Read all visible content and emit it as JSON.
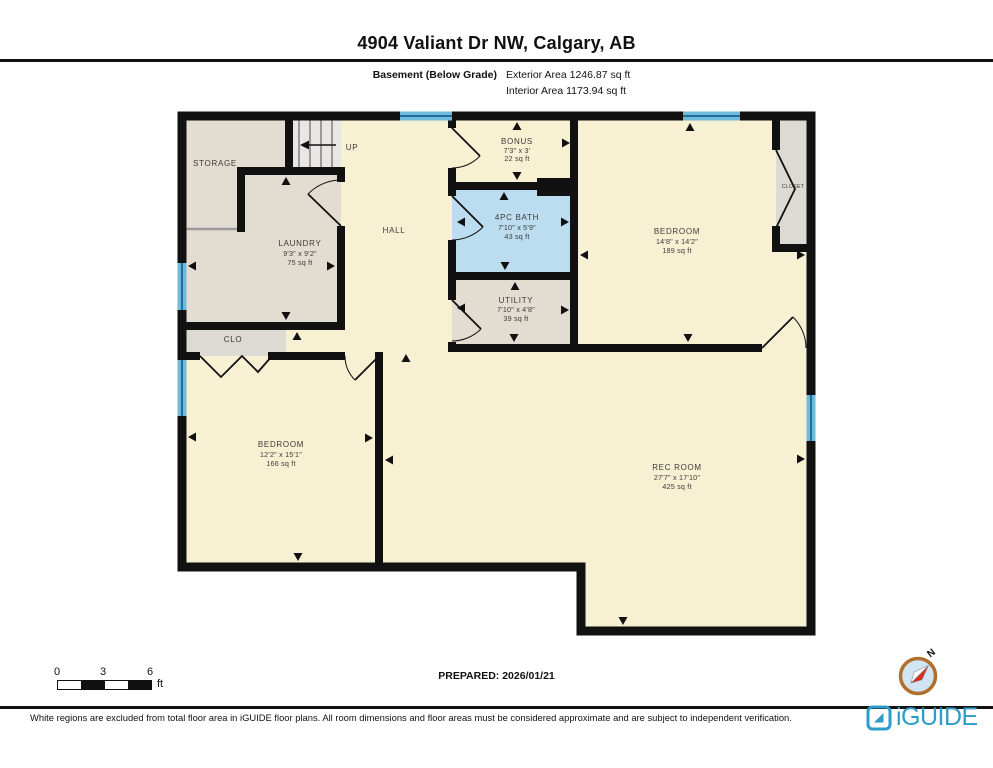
{
  "header": {
    "title": "4904 Valiant Dr NW, Calgary, AB",
    "floor_label": "Basement (Below Grade)",
    "exterior_area": "Exterior Area 1246.87 sq ft",
    "interior_area": "Interior Area 1173.94 sq ft"
  },
  "rooms": {
    "storage": {
      "name": "STORAGE"
    },
    "stairs": {
      "label": "UP"
    },
    "laundry": {
      "name": "LAUNDRY",
      "dims": "9'3\" x 9'2\"",
      "area": "75 sq ft"
    },
    "hall": {
      "name": "HALL"
    },
    "bonus": {
      "name": "BONUS",
      "dims": "7'3\" x 3'",
      "area": "22 sq ft"
    },
    "bath": {
      "name": "4PC BATH",
      "dims": "7'10\" x 5'9\"",
      "area": "43 sq ft"
    },
    "utility": {
      "name": "UTILITY",
      "dims": "7'10\" x 4'8\"",
      "area": "39 sq ft"
    },
    "bedroom_right": {
      "name": "BEDROOM",
      "dims": "14'8\" x 14'2\"",
      "area": "189 sq ft"
    },
    "closet_right": {
      "name": "CLOSET"
    },
    "closet_left": {
      "name": "CLO"
    },
    "bedroom_left": {
      "name": "BEDROOM",
      "dims": "12'2\" x 15'1\"",
      "area": "166 sq ft"
    },
    "rec_room": {
      "name": "REC ROOM",
      "dims": "27'7\" x 17'10\"",
      "area": "425 sq ft"
    }
  },
  "footer": {
    "scale": {
      "ticks": [
        "0",
        "3",
        "6"
      ],
      "unit": "ft"
    },
    "prepared": "PREPARED: 2026/01/21",
    "compass": {
      "north_label": "N"
    },
    "disclaimer": "White regions are excluded from total floor area in iGUIDE floor plans. All room dimensions and floor areas must be considered approximate and are subject to independent verification.",
    "brand": "iGUIDE"
  },
  "colors": {
    "room_fill": "#f8f0d3",
    "service_fill": "#e3dcd1",
    "closet_fill": "#dcdad2",
    "stairs_fill": "#e9e7e3",
    "bath_fill": "#bcdcf0",
    "wall": "#111111",
    "window": "#6fb9da",
    "window_line": "#1d6e99",
    "brand_blue": "#2e9cc9",
    "compass_ring": "#b06f2b",
    "needle_red": "#d82e20"
  }
}
